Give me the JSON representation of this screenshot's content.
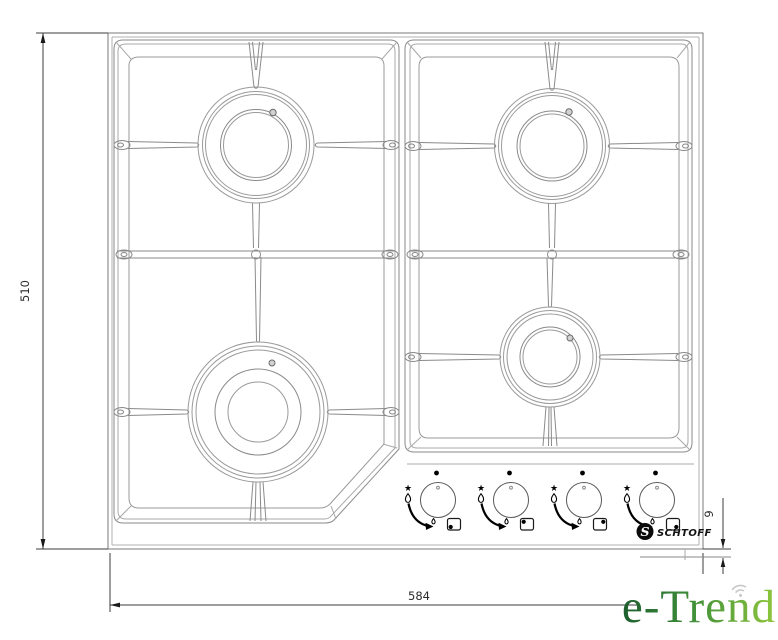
{
  "meta": {
    "kind": "technical-drawing",
    "subject": "Gas hob top view with 4 burners, pan supports, control knobs and installation dimensions"
  },
  "dimensions": {
    "height_mm": "510",
    "width_mm": "584",
    "front_edge_mm": "9"
  },
  "brand": {
    "badge_letter": "S",
    "name": "SCHTOFF"
  },
  "watermark": {
    "text": "e-Trend",
    "wifi_icon": "wifi-arcs"
  },
  "icons": {
    "star": "★"
  },
  "burners": [
    {
      "id": "rear-left",
      "size": "large",
      "igniter_dot": "upper-right"
    },
    {
      "id": "rear-right",
      "size": "large",
      "igniter_dot": "upper-right"
    },
    {
      "id": "front-left",
      "size": "extra-large",
      "igniter_dot": "upper-right"
    },
    {
      "id": "front-right",
      "size": "medium",
      "igniter_dot": "upper-right"
    }
  ],
  "knobs": [
    {
      "index": 1,
      "controls_burner": "front-left",
      "square_dot_corner": "bottom-left",
      "symbols": [
        "off-dot",
        "star-ignition",
        "large-flame",
        "rotation-arc",
        "small-flame",
        "burner-position-square"
      ]
    },
    {
      "index": 2,
      "controls_burner": "rear-left",
      "square_dot_corner": "top-left",
      "symbols": [
        "off-dot",
        "star-ignition",
        "large-flame",
        "rotation-arc",
        "small-flame",
        "burner-position-square"
      ]
    },
    {
      "index": 3,
      "controls_burner": "rear-right",
      "square_dot_corner": "top-right",
      "symbols": [
        "off-dot",
        "star-ignition",
        "large-flame",
        "rotation-arc",
        "small-flame",
        "burner-position-square"
      ]
    },
    {
      "index": 4,
      "controls_burner": "front-right",
      "square_dot_corner": "bottom-right",
      "symbols": [
        "off-dot",
        "star-ignition",
        "large-flame",
        "rotation-arc",
        "small-flame",
        "burner-position-square"
      ]
    }
  ],
  "colors": {
    "background": "#ffffff",
    "drawing_line": "#8a8a8a",
    "frame_line": "#7a7a7a",
    "dimension_line": "#3c3c3c",
    "icon_black": "#000000",
    "watermark_green_dark": "#1d5e2e",
    "watermark_green_mid": "#3f8f39",
    "watermark_green_light": "#8fc63d",
    "wifi_gray": "#c8c8c8"
  }
}
